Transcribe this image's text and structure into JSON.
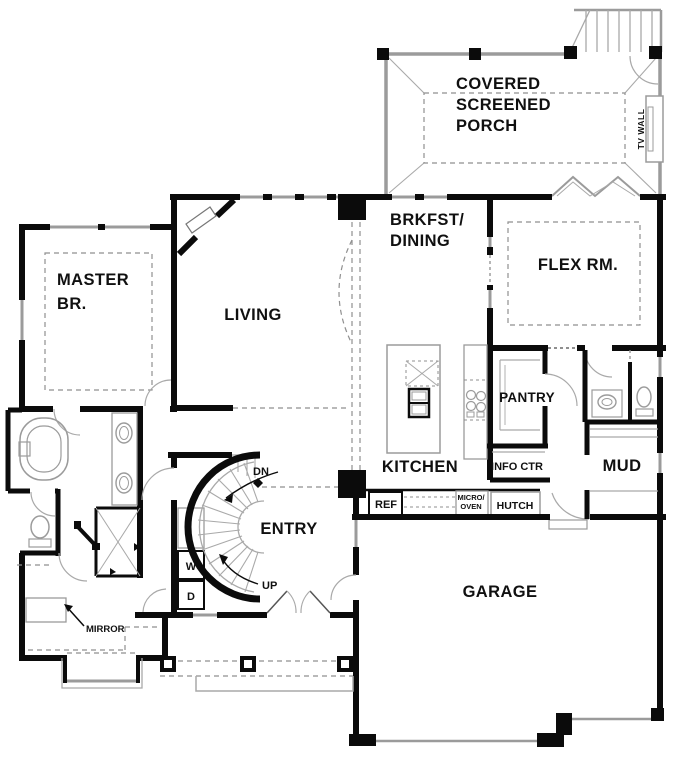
{
  "rooms": {
    "porch": [
      "COVERED",
      "SCREENED",
      "PORCH"
    ],
    "brkfst": [
      "BRKFST/",
      "DINING"
    ],
    "flex": "FLEX RM.",
    "master": [
      "MASTER",
      "BR."
    ],
    "living": "LIVING",
    "kitchen": "KITCHEN",
    "pantry": "PANTRY",
    "entry": "ENTRY",
    "mud": "MUD",
    "garage": "GARAGE"
  },
  "labels": {
    "info_ctr": "INFO CTR",
    "ref": "REF",
    "micro_oven": [
      "MICRO/",
      "OVEN"
    ],
    "hutch": "HUTCH",
    "tv_wall": "TV WALL",
    "mirror": "MIRROR",
    "dn": "DN",
    "up": "UP",
    "washer": "W",
    "dryer": "D"
  },
  "colors": {
    "wall": "#0b0b0b",
    "thin_gray": "#9b9b9b",
    "dashed_gray": "#8f8f8f",
    "background": "#ffffff"
  }
}
